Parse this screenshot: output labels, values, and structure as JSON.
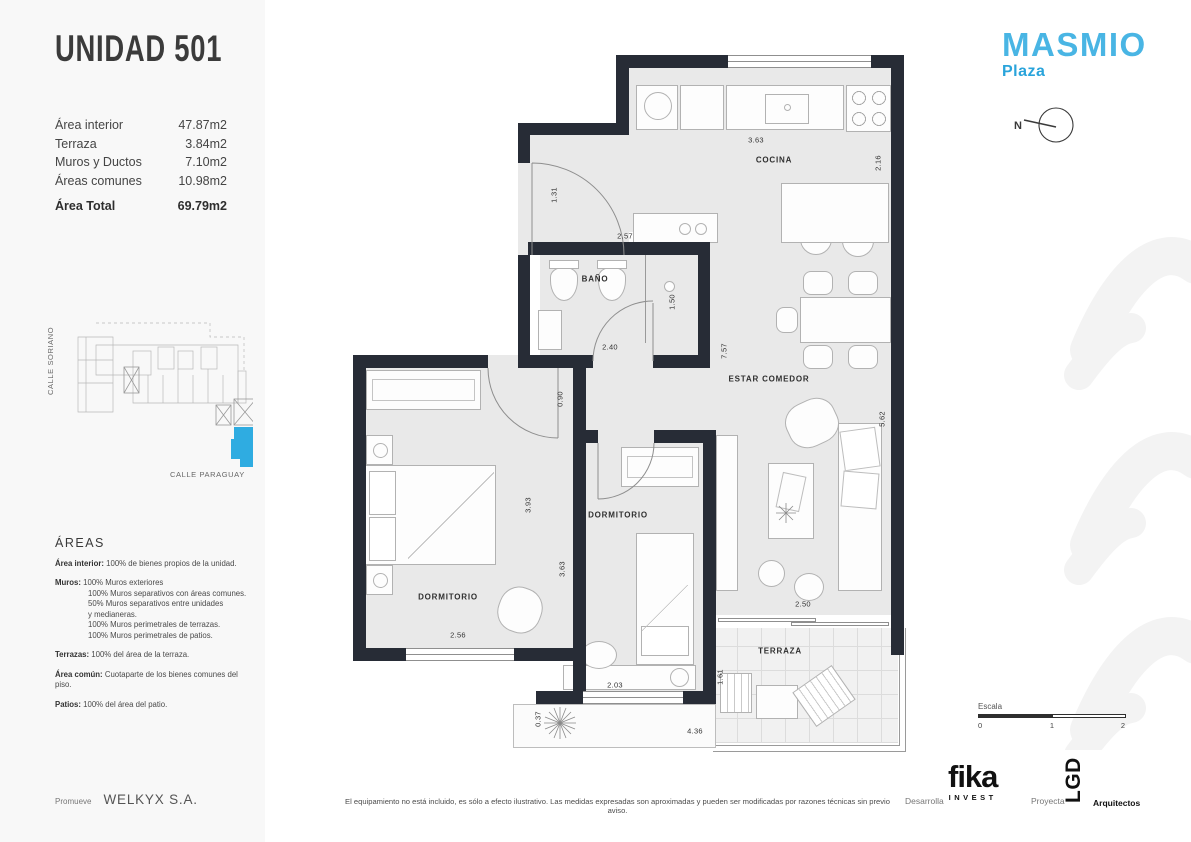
{
  "sidebar": {
    "title": "UNIDAD 501",
    "areas_table": {
      "rows": [
        {
          "label": "Área interior",
          "value": "47.87m2"
        },
        {
          "label": "Terraza",
          "value": "3.84m2"
        },
        {
          "label": "Muros y Ductos",
          "value": "7.10m2"
        },
        {
          "label": "Áreas comunes",
          "value": "10.98m2"
        }
      ],
      "total_label": "Área Total",
      "total_value": "69.79m2"
    },
    "location": {
      "street_left": "CALLE SORIANO",
      "street_bottom": "CALLE PARAGUAY",
      "unit_color": "#2FACE1"
    },
    "areas_info": {
      "heading": "ÁREAS",
      "items": [
        {
          "label": "Área interior:",
          "text": "100% de bienes propios de la unidad."
        },
        {
          "label": "Muros:",
          "text": "100% Muros exteriores",
          "lines": [
            "100% Muros separativos con áreas comunes.",
            "50%  Muros separativos entre unidades",
            "y medianeras.",
            "100% Muros perimetrales de terrazas.",
            "100% Muros perimetrales de patios."
          ]
        },
        {
          "label": "Terrazas:",
          "text": "100% del área de la terraza."
        },
        {
          "label": "Área común:",
          "text": "Cuotaparte de los bienes comunes del piso."
        },
        {
          "label": "Patios:",
          "text": "100% del área del patio."
        }
      ]
    },
    "promoter": {
      "label": "Promueve",
      "name": "WELKYX S.A."
    }
  },
  "header": {
    "brand": "MASMIO",
    "brand_sub": "Plaza",
    "north_label": "N"
  },
  "plan": {
    "room_labels": [
      {
        "t": "COCINA",
        "x": 426,
        "y": 105
      },
      {
        "t": "BAÑO",
        "x": 247,
        "y": 224
      },
      {
        "t": "ESTAR COMEDOR",
        "x": 421,
        "y": 324
      },
      {
        "t": "DORMITORIO",
        "x": 100,
        "y": 542
      },
      {
        "t": "DORMITORIO",
        "x": 270,
        "y": 460
      },
      {
        "t": "TERRAZA",
        "x": 432,
        "y": 596
      }
    ],
    "dimensions": [
      {
        "t": "3.63",
        "x": 408,
        "y": 85,
        "v": 0
      },
      {
        "t": "2.16",
        "x": 530,
        "y": 108,
        "v": 1
      },
      {
        "t": "1.31",
        "x": 206,
        "y": 140,
        "v": 1
      },
      {
        "t": "2.57",
        "x": 277,
        "y": 181,
        "v": 0
      },
      {
        "t": "1.50",
        "x": 324,
        "y": 247,
        "v": 1
      },
      {
        "t": "2.40",
        "x": 262,
        "y": 292,
        "v": 0
      },
      {
        "t": "7.57",
        "x": 376,
        "y": 296,
        "v": 1
      },
      {
        "t": "0.90",
        "x": 212,
        "y": 344,
        "v": 1
      },
      {
        "t": "5.62",
        "x": 534,
        "y": 364,
        "v": 1
      },
      {
        "t": "3.93",
        "x": 180,
        "y": 450,
        "v": 1
      },
      {
        "t": "3.63",
        "x": 214,
        "y": 514,
        "v": 1
      },
      {
        "t": "2.56",
        "x": 110,
        "y": 580,
        "v": 0
      },
      {
        "t": "2.50",
        "x": 455,
        "y": 549,
        "v": 0
      },
      {
        "t": "2.03",
        "x": 267,
        "y": 630,
        "v": 0
      },
      {
        "t": "1.61",
        "x": 372,
        "y": 622,
        "v": 1
      },
      {
        "t": "0.37",
        "x": 190,
        "y": 664,
        "v": 1
      },
      {
        "t": "4.36",
        "x": 347,
        "y": 676,
        "v": 0
      }
    ]
  },
  "footer": {
    "disclaimer": "El equipamiento no está incluido, es sólo a efecto ilustrativo. Las medidas expresadas son aproximadas y pueden ser modificadas por razones técnicas sin previo aviso.",
    "scale": {
      "label": "Escala",
      "ticks": [
        "0",
        "1",
        "2"
      ]
    },
    "developer": {
      "role": "Desarrolla",
      "brand": "fika",
      "brand_sub": "INVEST"
    },
    "architect": {
      "role": "Proyecta",
      "brand": "LGD",
      "brand_sub": "Arquitectos"
    }
  },
  "colors": {
    "accent_blue": "#2FACE1",
    "wall": "#272C36",
    "floor": "#E9E9E9"
  }
}
